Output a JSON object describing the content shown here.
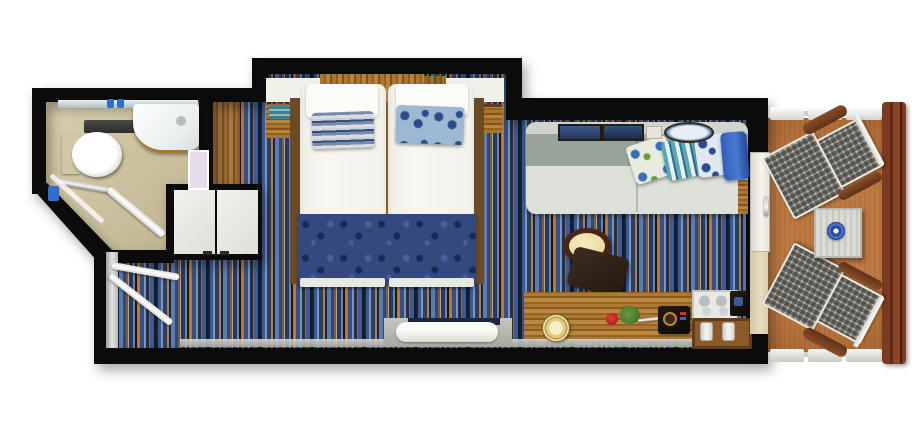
{
  "scene": {
    "type": "floor-plan",
    "view": "top-down",
    "subject": "cruise-ship balcony stateroom with bathroom, entry, twin beds, sitting area, desk and private balcony"
  },
  "rooms": [
    {
      "name": "bathroom",
      "items": [
        "mirror-strip",
        "sink-counter",
        "toilet",
        "toilet-cistern",
        "bathtub-shower",
        "shower-glass",
        "towel-rail",
        "shower-fixture",
        "bathroom-door",
        "shelf"
      ]
    },
    {
      "name": "entry",
      "items": [
        "cabin-door-leaf",
        "bathroom-door-leaf",
        "threshold",
        "wardrobe-double-doors",
        "wood-floor-strip"
      ]
    },
    {
      "name": "bedroom",
      "items": [
        "nightstand-shelf-left",
        "headboard-wood",
        "overhead-cabinet",
        "nightstand-shelf-right",
        "twin-mattress-left",
        "twin-mattress-right",
        "white-pillow-left",
        "white-pillow-right",
        "striped-pillow",
        "floral-pillow",
        "bed-runner",
        "bed-footboard",
        "side-rail-left",
        "side-rail-right",
        "towel-decor",
        "bedside-table-right"
      ]
    },
    {
      "name": "sitting-area",
      "items": [
        "sofa",
        "sofa-cushion-floral",
        "sofa-cushion-striped",
        "sofa-cushion-blue",
        "picture-frame-1",
        "picture-frame-2",
        "picture-card",
        "decor-plate",
        "round-table",
        "chair",
        "desk",
        "desk-lamp",
        "rose",
        "plant-sprig",
        "telephone",
        "glasses-tray",
        "radio",
        "bottle-tray",
        "bench",
        "baseboard"
      ]
    },
    {
      "name": "balcony",
      "items": [
        "sliding-door",
        "curtain-panel",
        "lounge-chair-top",
        "lounge-chair-bottom",
        "balcony-table",
        "blue-plate",
        "railing-top",
        "railing-bottom",
        "railing-wood-right"
      ]
    }
  ],
  "colors": {
    "bg": "#ffffff",
    "wall": "#0b0b0b",
    "bathroom_floor": "#cdc3a2",
    "carpet_blue": "#3c5b92",
    "carpet_navy": "#16213a",
    "carpet_orange": "#b87c3e",
    "wood": "#a9762f",
    "wood_dark": "#6b4a26",
    "balcony_floor": "#b4713b",
    "balcony_rail_wood": "#7c3a20",
    "mattress": "#f6f5f0",
    "bed_runner": "#34497e",
    "runner_swirl": "#1c2a52",
    "striped_pillow": "#7a8aa8",
    "floral_pillow": "#9cb8d2",
    "sofa_seat": "#dde1da",
    "sofa_back": "#9aa39b",
    "sofa_ledge": "#cfd4cc",
    "table_rim": "#4a2516",
    "table_top": "#f2e4ae",
    "chair_seat": "#33261a",
    "lamp": "#f4ecc0",
    "rose": "#c21f1f",
    "plant": "#4e7d33",
    "mesh_gray": "#8e8d88",
    "white_furniture": "#f0efe8",
    "threshold_silver": "#c9c9c4",
    "cushion_blue": "#2f5fb8",
    "teal_decor": "#3f7f8f",
    "plate_blue": "#2b4ea8",
    "lavender_shelf": "#e7dcec"
  }
}
